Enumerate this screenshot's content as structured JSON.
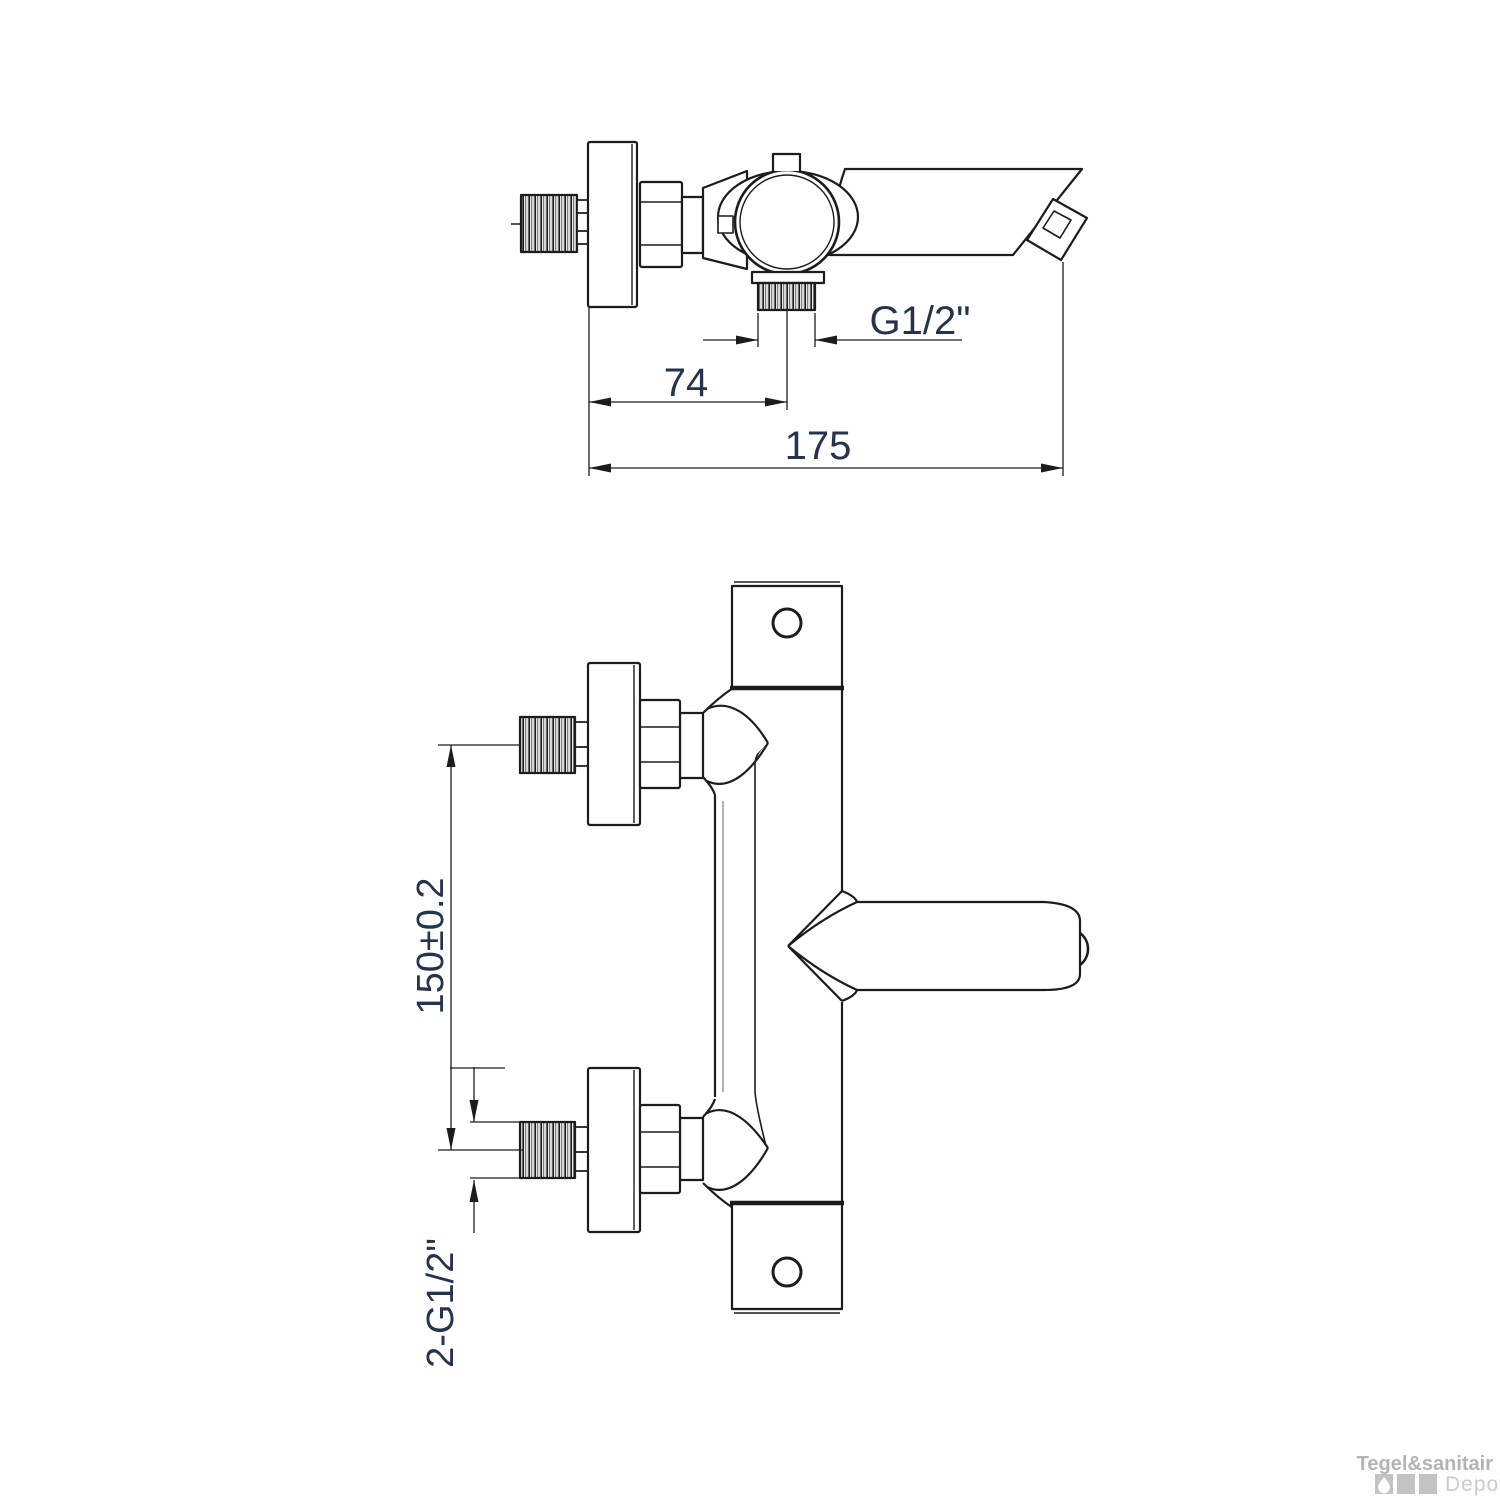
{
  "drawing": {
    "background": "#ffffff",
    "line_color": "#1c1c1c",
    "dim_text_color": "#26334d",
    "side_view": {
      "title": "side-view-of-bath-mixer",
      "dim_outlet_thread": "G1/2\"",
      "dim_outlet_offset": "74",
      "dim_total_depth": "175"
    },
    "front_view": {
      "title": "front-view-of-bath-mixer",
      "dim_inlet_distance": "150±0.2",
      "dim_inlet_threads": "2-G1/2\""
    }
  },
  "watermark": {
    "brand": "Tegel&sanitair",
    "sub": "Depot",
    "icon": "water-drop-icon",
    "brand_color": "#b4b4b4",
    "sub_color": "#cccccc",
    "tile_color": "#c3c3c3"
  }
}
